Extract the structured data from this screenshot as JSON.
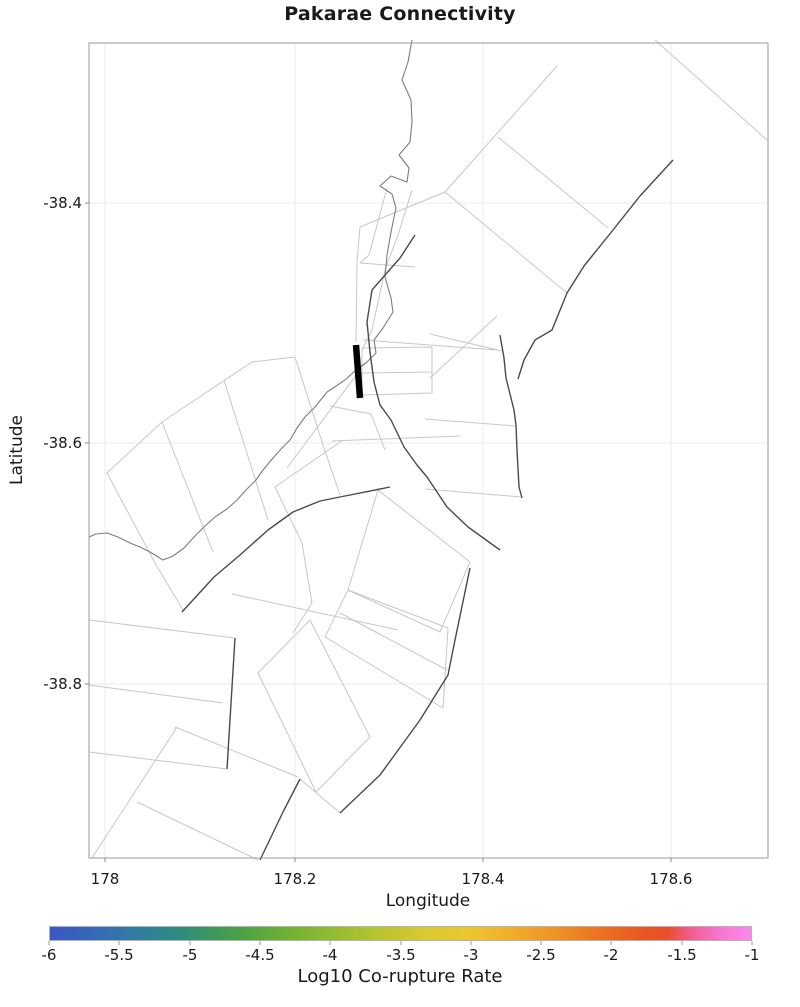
{
  "title": "Pakarae Connectivity",
  "axes": {
    "xlabel": "Longitude",
    "ylabel": "Latitude",
    "xlim": [
      177.983,
      178.703
    ],
    "ylim": [
      -38.945,
      -38.267
    ],
    "x_ticks": [
      {
        "label": "178",
        "value": 178.0,
        "px": 105
      },
      {
        "label": "178.2",
        "value": 178.2,
        "px": 295
      },
      {
        "label": "178.4",
        "value": 178.4,
        "px": 483
      },
      {
        "label": "178.6",
        "value": 178.6,
        "px": 671
      }
    ],
    "y_ticks": [
      {
        "label": "-38.4",
        "value": -38.4,
        "px": 203
      },
      {
        "label": "-38.6",
        "value": -38.6,
        "px": 443
      },
      {
        "label": "-38.8",
        "value": -38.8,
        "px": 684
      }
    ],
    "plot_rect_px": {
      "left": 89,
      "top": 43,
      "right": 768,
      "bottom": 858
    },
    "grid_color": "#ebebeb",
    "frame_color": "#9a9a9a"
  },
  "colorbar": {
    "label": "Log10 Co-rupture Rate",
    "tick_labels": [
      "-6",
      "-5.5",
      "-5",
      "-4.5",
      "-4",
      "-3.5",
      "-3",
      "-2.5",
      "-2",
      "-1.5",
      "-1"
    ],
    "tick_values": [
      -6,
      -5.5,
      -5,
      -4.5,
      -4,
      -3.5,
      -3,
      -2.5,
      -2,
      -1.5,
      -1
    ],
    "tick_px": [
      49,
      119,
      190,
      260,
      330,
      401,
      471,
      541,
      611,
      682,
      752
    ],
    "bar_px": {
      "left": 49,
      "top": 926,
      "width": 703,
      "height": 15
    },
    "gradient": [
      {
        "pos": 0.0,
        "color": "#3b57c4"
      },
      {
        "pos": 0.06,
        "color": "#3568b8"
      },
      {
        "pos": 0.12,
        "color": "#317ba4"
      },
      {
        "pos": 0.18,
        "color": "#2f8b82"
      },
      {
        "pos": 0.24,
        "color": "#3d9a55"
      },
      {
        "pos": 0.3,
        "color": "#5aa83c"
      },
      {
        "pos": 0.36,
        "color": "#7cb433"
      },
      {
        "pos": 0.42,
        "color": "#9cbe31"
      },
      {
        "pos": 0.48,
        "color": "#bdc52f"
      },
      {
        "pos": 0.54,
        "color": "#dcca31"
      },
      {
        "pos": 0.6,
        "color": "#edc52f"
      },
      {
        "pos": 0.66,
        "color": "#f1ad2a"
      },
      {
        "pos": 0.72,
        "color": "#ef9226"
      },
      {
        "pos": 0.78,
        "color": "#ec7421"
      },
      {
        "pos": 0.84,
        "color": "#e95a20"
      },
      {
        "pos": 0.88,
        "color": "#e94e2b"
      },
      {
        "pos": 0.92,
        "color": "#f2619b"
      },
      {
        "pos": 0.96,
        "color": "#f778d3"
      },
      {
        "pos": 1.0,
        "color": "#fa8aec"
      }
    ]
  },
  "chart_data": {
    "type": "map",
    "title": "Pakarae Connectivity",
    "xlabel": "Longitude",
    "ylabel": "Latitude",
    "xlim": [
      177.983,
      178.703
    ],
    "ylim": [
      -38.945,
      -38.267
    ],
    "grid": true,
    "legend": "colorbar bottom, Log10 Co-rupture Rate from -6 to -1",
    "highlight_fault": {
      "color": "#000000",
      "lon": 178.266,
      "lat_range": [
        -38.518,
        -38.562
      ],
      "points_px": [
        [
          356,
          345
        ],
        [
          360,
          398
        ]
      ],
      "stroke_width": 6.5
    },
    "coastline": {
      "color": "#7d7d7d",
      "stroke_width": 1.1,
      "points_px": [
        [
          412,
          40
        ],
        [
          408,
          62
        ],
        [
          402,
          80
        ],
        [
          411,
          100
        ],
        [
          412,
          122
        ],
        [
          410,
          142
        ],
        [
          399,
          155
        ],
        [
          409,
          168
        ],
        [
          407,
          182
        ],
        [
          391,
          176
        ],
        [
          380,
          186
        ],
        [
          392,
          194
        ],
        [
          396,
          208
        ],
        [
          391,
          232
        ],
        [
          387,
          255
        ],
        [
          385,
          277
        ],
        [
          391,
          298
        ],
        [
          393,
          312
        ],
        [
          383,
          328
        ],
        [
          374,
          340
        ],
        [
          376,
          353
        ],
        [
          367,
          362
        ],
        [
          356,
          370
        ],
        [
          345,
          380
        ],
        [
          336,
          386
        ],
        [
          327,
          392
        ],
        [
          315,
          407
        ],
        [
          305,
          417
        ],
        [
          297,
          428
        ],
        [
          290,
          440
        ],
        [
          282,
          448
        ],
        [
          273,
          458
        ],
        [
          263,
          470
        ],
        [
          256,
          480
        ],
        [
          246,
          490
        ],
        [
          237,
          500
        ],
        [
          227,
          509
        ],
        [
          215,
          517
        ],
        [
          205,
          526
        ],
        [
          194,
          537
        ],
        [
          184,
          548
        ],
        [
          173,
          556
        ],
        [
          163,
          560
        ],
        [
          150,
          552
        ],
        [
          140,
          547
        ],
        [
          130,
          543
        ],
        [
          118,
          537
        ],
        [
          107,
          533
        ],
        [
          96,
          534
        ],
        [
          89,
          537
        ]
      ]
    },
    "fault_traces_dark": {
      "color": "#4a4a4a",
      "stroke_width": 1.4,
      "polylines_px": [
        [
          [
            673,
            160
          ],
          [
            640,
            196
          ],
          [
            613,
            230
          ],
          [
            584,
            266
          ],
          [
            567,
            293
          ],
          [
            552,
            330
          ],
          [
            535,
            340
          ],
          [
            524,
            360
          ],
          [
            518,
            379
          ]
        ],
        [
          [
            500,
            335
          ],
          [
            504,
            358
          ],
          [
            506,
            378
          ],
          [
            514,
            410
          ],
          [
            516,
            425
          ],
          [
            517,
            450
          ],
          [
            519,
            487
          ],
          [
            522,
            498
          ]
        ],
        [
          [
            182,
            612
          ],
          [
            214,
            577
          ],
          [
            240,
            555
          ],
          [
            268,
            530
          ],
          [
            293,
            512
          ],
          [
            320,
            501
          ],
          [
            350,
            495
          ],
          [
            390,
            487
          ]
        ],
        [
          [
            415,
            235
          ],
          [
            400,
            258
          ],
          [
            372,
            290
          ],
          [
            367,
            322
          ],
          [
            370,
            352
          ],
          [
            374,
            382
          ],
          [
            380,
            405
          ],
          [
            391,
            420
          ],
          [
            404,
            447
          ],
          [
            417,
            465
          ],
          [
            427,
            477
          ],
          [
            447,
            507
          ],
          [
            468,
            527
          ],
          [
            500,
            550
          ]
        ],
        [
          [
            470,
            568
          ],
          [
            455,
            640
          ],
          [
            448,
            675
          ],
          [
            420,
            720
          ],
          [
            380,
            775
          ],
          [
            340,
            813
          ]
        ],
        [
          [
            300,
            779
          ],
          [
            283,
            812
          ],
          [
            260,
            860
          ]
        ],
        [
          [
            235,
            638
          ],
          [
            227,
            769
          ]
        ]
      ]
    },
    "fault_outlines_light": {
      "color": "#c7c7c7",
      "stroke_width": 1,
      "polylines_px": [
        [
          [
            655,
            40
          ],
          [
            767,
            140
          ]
        ],
        [
          [
            557,
            66
          ],
          [
            445,
            192
          ]
        ],
        [
          [
            498,
            137
          ],
          [
            608,
            228
          ]
        ],
        [
          [
            445,
            192
          ],
          [
            567,
            293
          ]
        ],
        [
          [
            445,
            192
          ],
          [
            360,
            227
          ]
        ],
        [
          [
            360,
            227
          ],
          [
            357,
            262
          ],
          [
            356,
            342
          ]
        ],
        [
          [
            387,
            188
          ],
          [
            369,
            255
          ],
          [
            360,
            263
          ]
        ],
        [
          [
            412,
            190
          ],
          [
            398,
            235
          ],
          [
            385,
            270
          ]
        ],
        [
          [
            360,
            263
          ],
          [
            415,
            267
          ]
        ],
        [
          [
            385,
            270
          ],
          [
            372,
            330
          ],
          [
            363,
            348
          ]
        ],
        [
          [
            362,
            348
          ],
          [
            432,
            347
          ],
          [
            432,
            372
          ],
          [
            362,
            373
          ],
          [
            362,
            348
          ]
        ],
        [
          [
            362,
            373
          ],
          [
            362,
            395
          ],
          [
            432,
            393
          ],
          [
            432,
            372
          ]
        ],
        [
          [
            363,
            340
          ],
          [
            497,
            350
          ]
        ],
        [
          [
            430,
            334
          ],
          [
            502,
            351
          ]
        ],
        [
          [
            497,
            316
          ],
          [
            430,
            378
          ]
        ],
        [
          [
            425,
            419
          ],
          [
            515,
            426
          ]
        ],
        [
          [
            425,
            489
          ],
          [
            521,
            497
          ]
        ],
        [
          [
            366,
            362
          ],
          [
            287,
            468
          ]
        ],
        [
          [
            330,
            406
          ],
          [
            371,
            414
          ]
        ],
        [
          [
            371,
            414
          ],
          [
            385,
            450
          ]
        ],
        [
          [
            332,
            441
          ],
          [
            460,
            436
          ]
        ],
        [
          [
            295,
            357
          ],
          [
            252,
            362
          ],
          [
            162,
            422
          ],
          [
            107,
            473
          ],
          [
            155,
            563
          ],
          [
            183,
            610
          ]
        ],
        [
          [
            295,
            357
          ],
          [
            323,
            445
          ],
          [
            340,
            495
          ]
        ],
        [
          [
            162,
            422
          ],
          [
            213,
            552
          ]
        ],
        [
          [
            224,
            380
          ],
          [
            268,
            520
          ]
        ],
        [
          [
            275,
            487
          ],
          [
            343,
            440
          ]
        ],
        [
          [
            275,
            487
          ],
          [
            302,
            543
          ],
          [
            312,
            603
          ],
          [
            293,
            633
          ]
        ],
        [
          [
            232,
            594
          ],
          [
            398,
            630
          ]
        ],
        [
          [
            378,
            490
          ],
          [
            470,
            562
          ],
          [
            440,
            632
          ],
          [
            348,
            590
          ],
          [
            378,
            490
          ]
        ],
        [
          [
            348,
            590
          ],
          [
            448,
            628
          ],
          [
            443,
            708
          ],
          [
            325,
            637
          ],
          [
            348,
            590
          ]
        ],
        [
          [
            340,
            613
          ],
          [
            447,
            670
          ]
        ],
        [
          [
            310,
            620
          ],
          [
            370,
            737
          ],
          [
            316,
            792
          ],
          [
            258,
            673
          ],
          [
            310,
            620
          ]
        ],
        [
          [
            89,
            620
          ],
          [
            235,
            638
          ]
        ],
        [
          [
            89,
            752
          ],
          [
            227,
            769
          ]
        ],
        [
          [
            89,
            685
          ],
          [
            223,
            703
          ]
        ],
        [
          [
            177,
            727
          ],
          [
            92,
            858
          ]
        ],
        [
          [
            175,
            727
          ],
          [
            298,
            777
          ]
        ],
        [
          [
            137,
            802
          ],
          [
            258,
            860
          ]
        ],
        [
          [
            300,
            779
          ],
          [
            340,
            813
          ]
        ]
      ]
    }
  }
}
